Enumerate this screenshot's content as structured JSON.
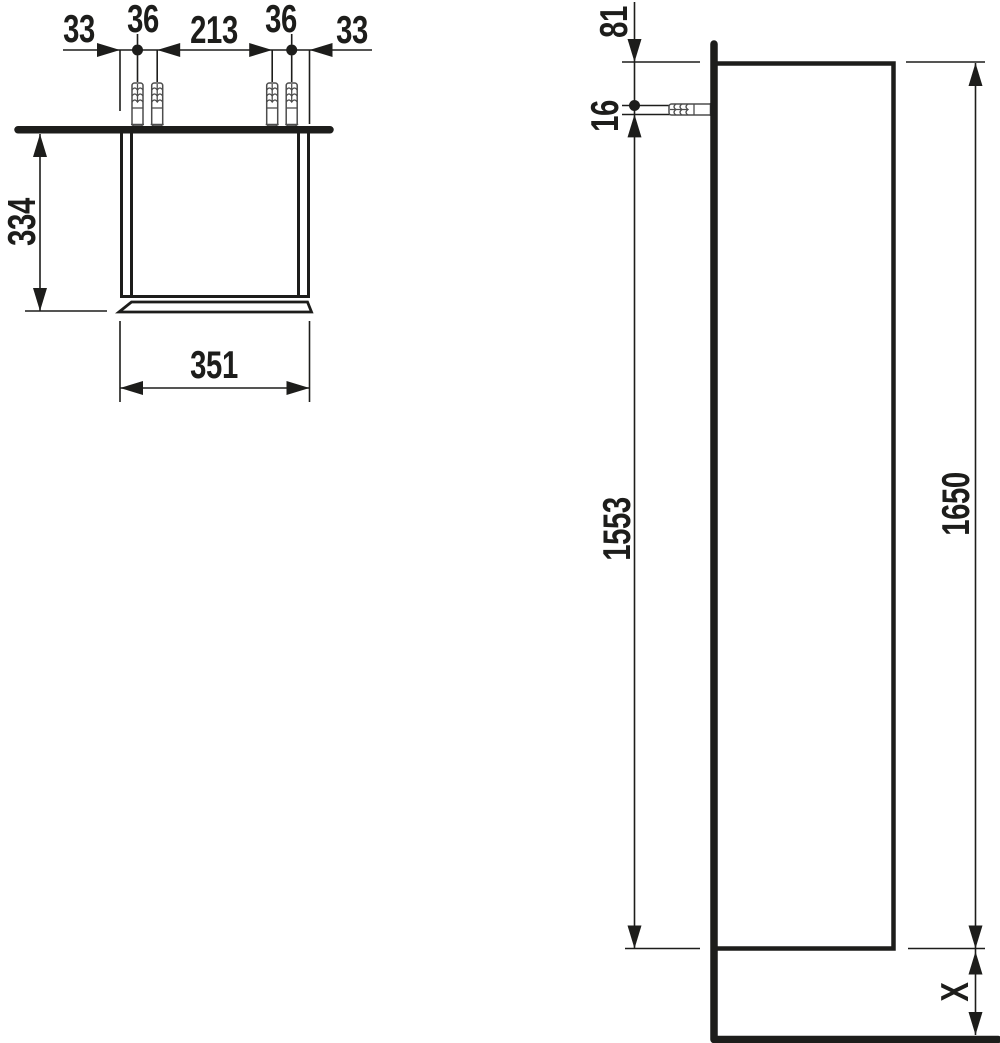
{
  "top_view": {
    "chain": [
      {
        "label": "33"
      },
      {
        "label": "36"
      },
      {
        "label": "213"
      },
      {
        "label": "36"
      },
      {
        "label": "33"
      }
    ],
    "depth": {
      "label": "334"
    },
    "width": {
      "label": "351"
    }
  },
  "side_view": {
    "top_to_hole": {
      "label": "81"
    },
    "hole": {
      "label": "16"
    },
    "hole_to_bottom": {
      "label": "1553"
    },
    "height": {
      "label": "1650"
    },
    "bottom_clearance": {
      "label": "X"
    }
  },
  "colors": {
    "line": "#1d1d1b",
    "hardware": "#4d4d4d",
    "background": "#ffffff"
  }
}
